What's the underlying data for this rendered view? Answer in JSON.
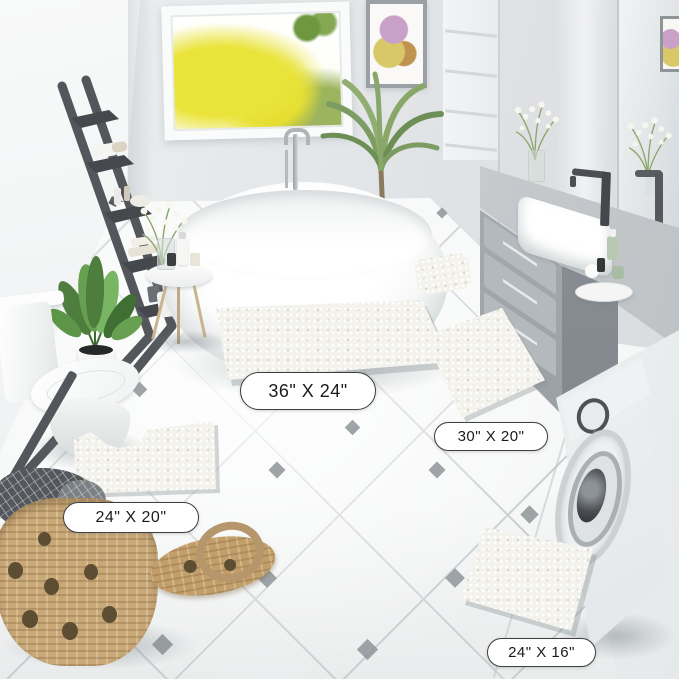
{
  "image": {
    "kind": "bathroom product photo",
    "subject": "white chenille bath mat set shown in four sizes"
  },
  "mats": [
    {
      "name": "bath-mat-36x24",
      "label": "36\" X 24\""
    },
    {
      "name": "bath-mat-30x20",
      "label": "30\" X 20\""
    },
    {
      "name": "contour-mat-24x20",
      "label": "24\" X 20\""
    },
    {
      "name": "bath-mat-24x16",
      "label": "24\" X 16\""
    }
  ],
  "colors": {
    "wall": "#e4e7e9",
    "floor": "#f6f7f7",
    "mat": "#f3f2ec",
    "label_border": "#3f3f3f",
    "label_text": "#1b1b1b",
    "ladder_dark_gray": "#53575c",
    "vanity_gray": "#9aa0a5",
    "basket_tan": "#c9a878",
    "plant_green": "#67a050",
    "tree_yellow": "#eae336"
  }
}
